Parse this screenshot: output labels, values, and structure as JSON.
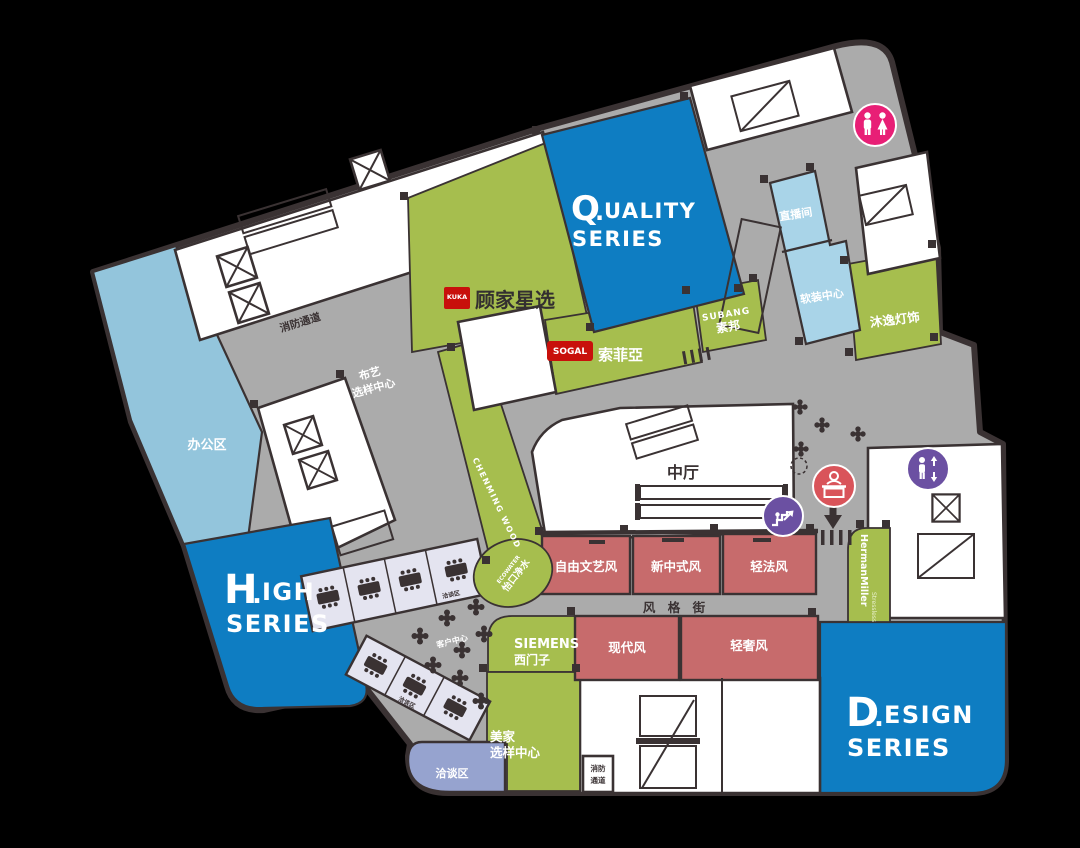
{
  "colors": {
    "background": "#000000",
    "wall": "#3A3233",
    "corridor": "#ABABAB",
    "series_blue": "#0E7DC2",
    "office_blue": "#93C5DC",
    "pale_blue": "#A9D4E8",
    "brand_green": "#A6BE4E",
    "style_red": "#C76B6C",
    "seating_lavender": "#E4E4F0",
    "negotiation_periwinkle": "#96A3CF",
    "wc_pink": "#E81F76",
    "icon_purple": "#6B50A2",
    "icon_red": "#D9545A",
    "logo_red": "#C8100B",
    "accent_red": "#E5322D"
  },
  "series_blocks": {
    "quality": {
      "initial": "Q",
      "dot": ".",
      "rest": "UALITY",
      "line2": "SERIES"
    },
    "high": {
      "initial": "H",
      "dot": ".",
      "rest": "IGH",
      "line2": "SERIES"
    },
    "design": {
      "initial": "D",
      "dot": ".",
      "rest": "ESIGN",
      "line2": "SERIES"
    }
  },
  "areas": {
    "office": "办公区",
    "fire_passage_top": "消防通道",
    "fire_passage_bottom_line1": "消防",
    "fire_passage_bottom_line2": "通道",
    "fabric_center_line1": "布艺",
    "fabric_center_line2": "选样中心",
    "atrium": "中厅",
    "style_street": "风 格 街",
    "customer_center": "客户中心",
    "live_room": "直播间",
    "soft_deco_center": "软装中心",
    "meijia_line1": "美家",
    "meijia_line2": "选样中心",
    "negotiation_area": "洽谈区",
    "negotiation_upper": "洽谈区",
    "negotiation_lower": "洽谈区"
  },
  "brands": {
    "kuka_logo": "KUKA",
    "kuka_name": "顾家星选",
    "sogal_logo": "SOGAL",
    "sogal_name": "索菲亞",
    "subang_en": "SUBANG",
    "subang_cn": "素邦",
    "muyi_lighting": "沐逸灯饰",
    "chenming": "CHENMING WOOD",
    "ecowater_en": "ECOWATER",
    "ecowater_cn": "怡口净水",
    "siemens_en": "SIEMENS",
    "siemens_cn": "西门子",
    "hermanmiller": "HermanMiller",
    "stressless": "Stressless"
  },
  "style_rooms": {
    "row1": [
      "自由文艺风",
      "新中式风",
      "轻法风"
    ],
    "row2": [
      "现代风",
      "轻奢风"
    ]
  },
  "icons": {
    "restroom": "restroom-icon",
    "escalator": "escalator-icon",
    "reception": "reception-icon",
    "elevator": "elevator-icon",
    "entrance_arrow": "entrance-arrow-icon"
  }
}
